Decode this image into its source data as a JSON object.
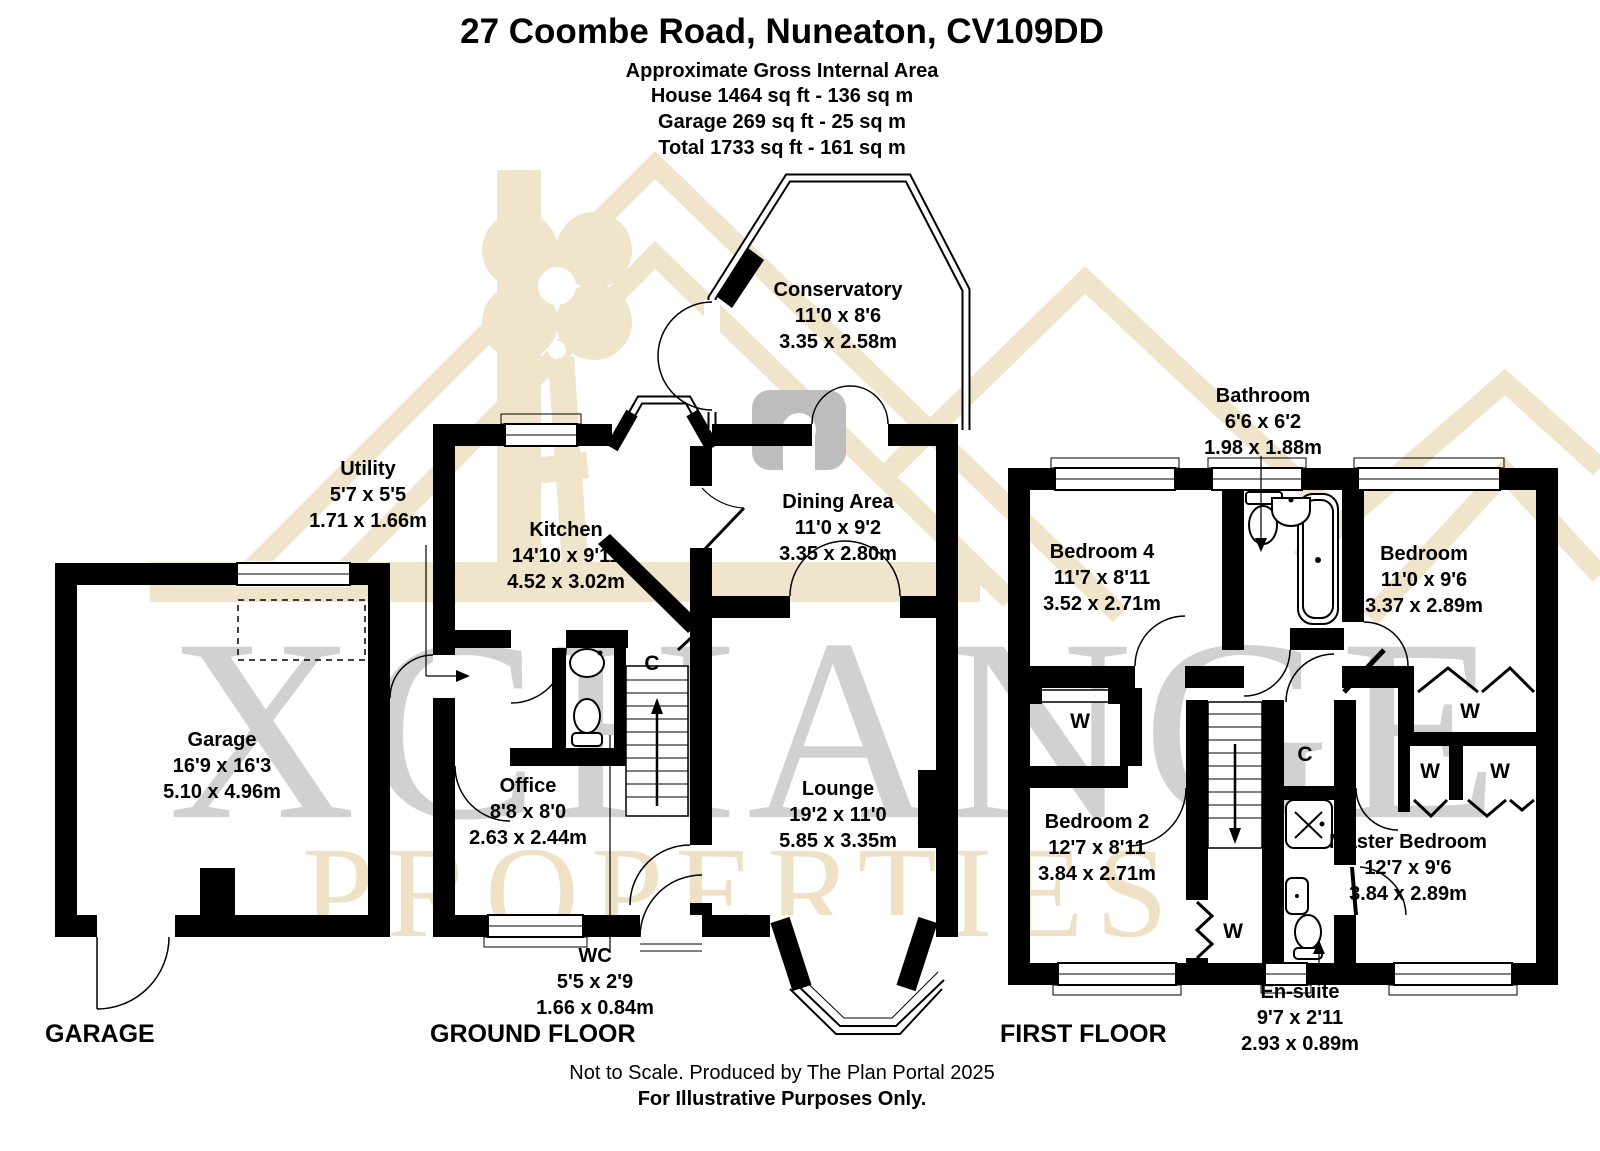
{
  "header": {
    "title": "27 Coombe Road, Nuneaton, CV109DD",
    "subtitle": "Approximate Gross Internal Area",
    "area_lines": [
      "House 1464 sq ft - 136 sq m",
      "Garage 269 sq ft - 25 sq m",
      "Total 1733 sq ft - 161 sq m"
    ]
  },
  "rooms": [
    {
      "name": "Garage",
      "imperial": "16'9 x 16'3",
      "metric": "5.10 x 4.96m"
    },
    {
      "name": "Utility",
      "imperial": "5'7 x 5'5",
      "metric": "1.71 x 1.66m"
    },
    {
      "name": "Kitchen",
      "imperial": "14'10 x 9'11",
      "metric": "4.52 x 3.02m"
    },
    {
      "name": "Conservatory",
      "imperial": "11'0 x 8'6",
      "metric": "3.35 x 2.58m"
    },
    {
      "name": "Dining Area",
      "imperial": "11'0 x 9'2",
      "metric": "3.35 x 2.80m"
    },
    {
      "name": "Office",
      "imperial": "8'8 x 8'0",
      "metric": "2.63 x 2.44m"
    },
    {
      "name": "WC",
      "imperial": "5'5 x 2'9",
      "metric": "1.66 x 0.84m"
    },
    {
      "name": "Lounge",
      "imperial": "19'2 x 11'0",
      "metric": "5.85 x 3.35m"
    },
    {
      "name": "Bathroom",
      "imperial": "6'6 x 6'2",
      "metric": "1.98 x 1.88m"
    },
    {
      "name": "Bedroom 4",
      "imperial": "11'7 x 8'11",
      "metric": "3.52 x 2.71m"
    },
    {
      "name": "Bedroom",
      "imperial": "11'0 x 9'6",
      "metric": "3.37 x 2.89m"
    },
    {
      "name": "Bedroom 2",
      "imperial": "12'7 x 8'11",
      "metric": "3.84 x 2.71m"
    },
    {
      "name": "Master Bedroom",
      "imperial": "12'7 x 9'6",
      "metric": "3.84 x 2.89m"
    },
    {
      "name": "En-suite",
      "imperial": "9'7 x 2'11",
      "metric": "2.93 x 0.89m"
    }
  ],
  "closets": {
    "cupboard": "C",
    "wardrobe": "W"
  },
  "floor_labels": [
    "GARAGE",
    "GROUND FLOOR",
    "FIRST FLOOR"
  ],
  "watermark": {
    "line1": "XCHANGE",
    "line2": "PROPERTIES"
  },
  "footer": {
    "line1": "Not to Scale. Produced by The Plan Portal 2025",
    "line2": "For Illustrative Purposes Only."
  },
  "colors": {
    "wall": "#000000",
    "watermark_beige": "#f0e4cb",
    "watermark_gray": "#c9c9c9"
  }
}
